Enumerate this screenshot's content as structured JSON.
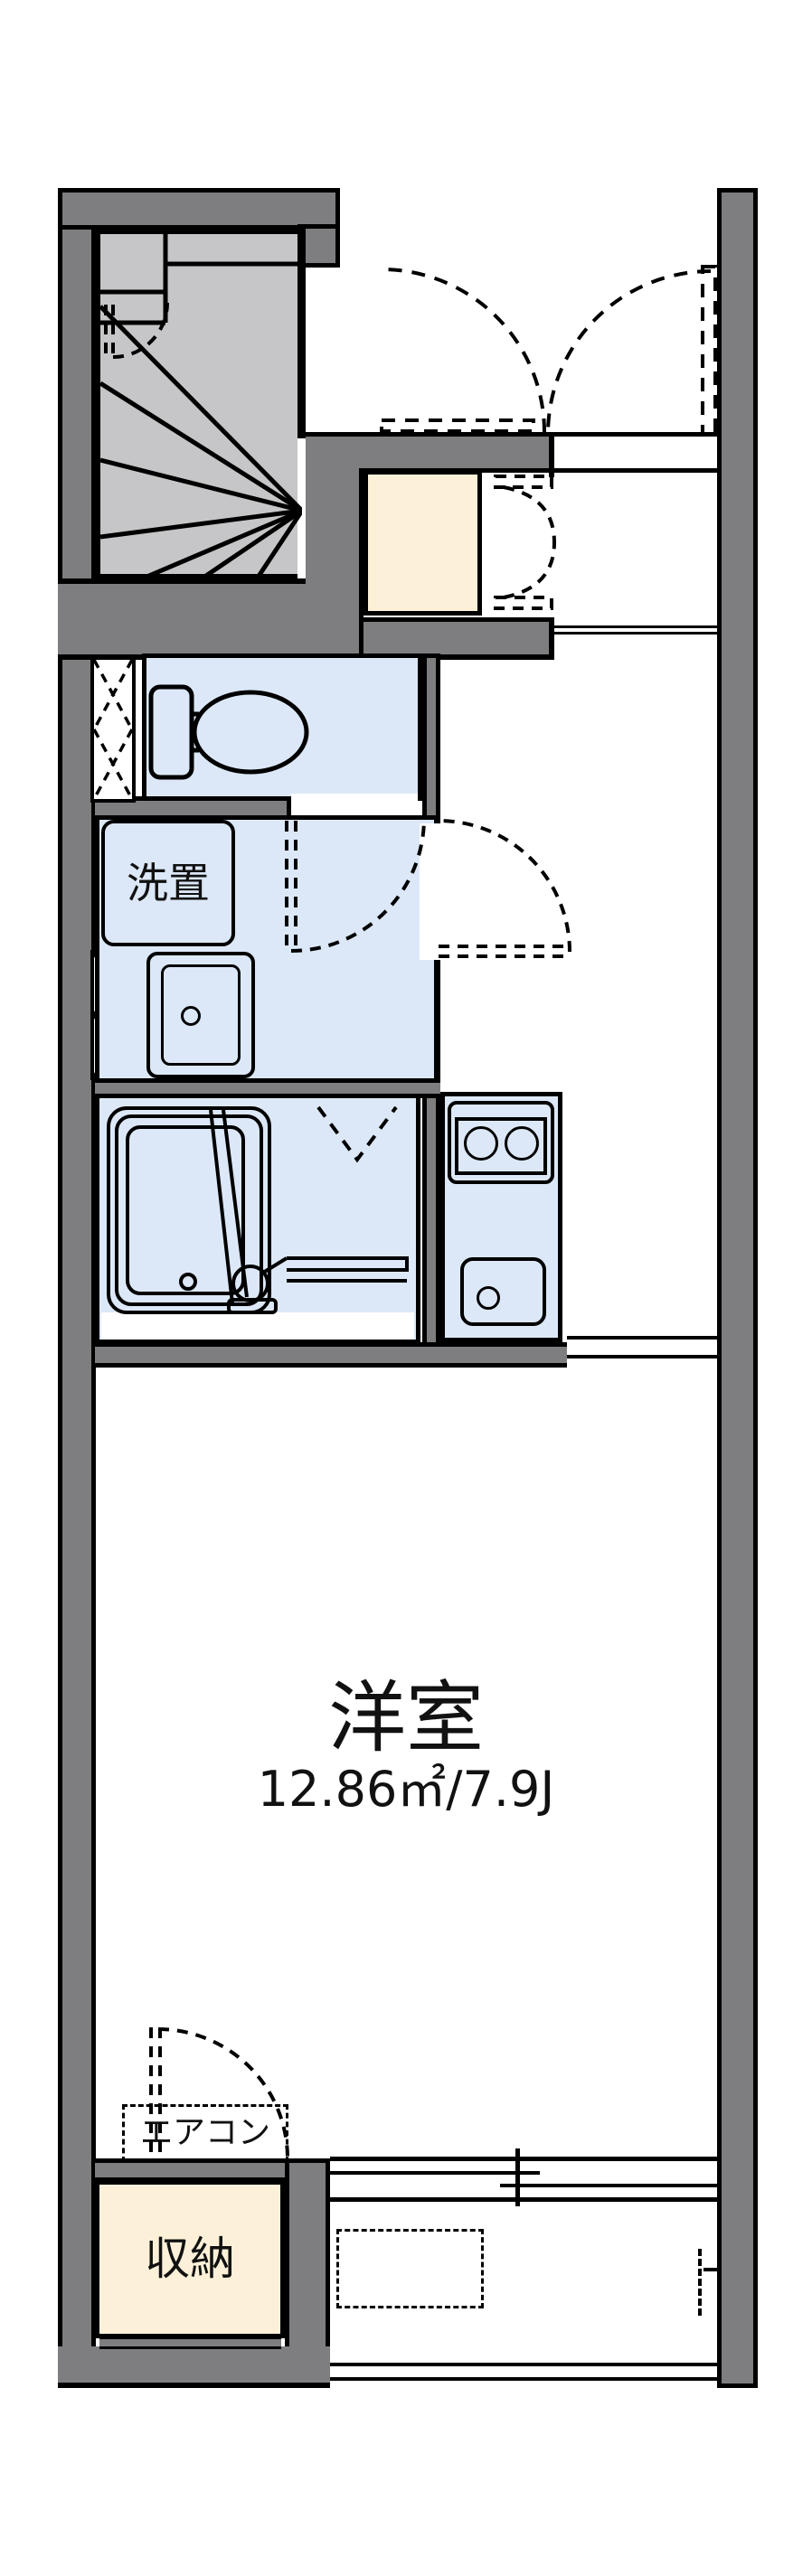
{
  "title": "apartment floor plan",
  "rooms": {
    "main_room": {
      "name": "洋室",
      "size": "12.86㎡/7.9J"
    },
    "storage": {
      "name": "収納"
    },
    "laundry": {
      "name": "洗置"
    },
    "aircon": {
      "name": "エアコン"
    }
  },
  "colors": {
    "wall": "#7e7e81",
    "stair_floor": "#c6c6c8",
    "wet_room_floor": "#dce8f7",
    "closet_fill": "#fcf1d8",
    "line": "#000000",
    "background": "#ffffff"
  }
}
